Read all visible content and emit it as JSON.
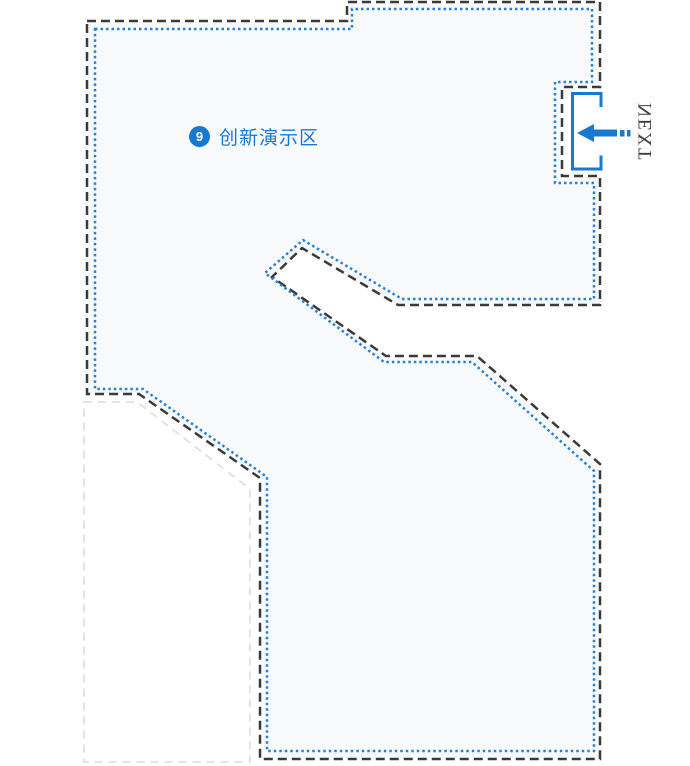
{
  "map": {
    "area": {
      "badge": "9",
      "label": "创新演示区"
    },
    "next_label": "NEXT",
    "icons": {
      "door": "entrance-door-icon",
      "arrow": "arrow-left-icon"
    },
    "colors": {
      "accent_blue": "#1878d2",
      "dotted_blue": "#2580d6",
      "border_dark": "#3a3a3a",
      "border_light": "#e3e3e3",
      "region_fill": "#f8f9fa",
      "next_text": "#3d3d3d",
      "badge_text": "#ffffff"
    }
  }
}
